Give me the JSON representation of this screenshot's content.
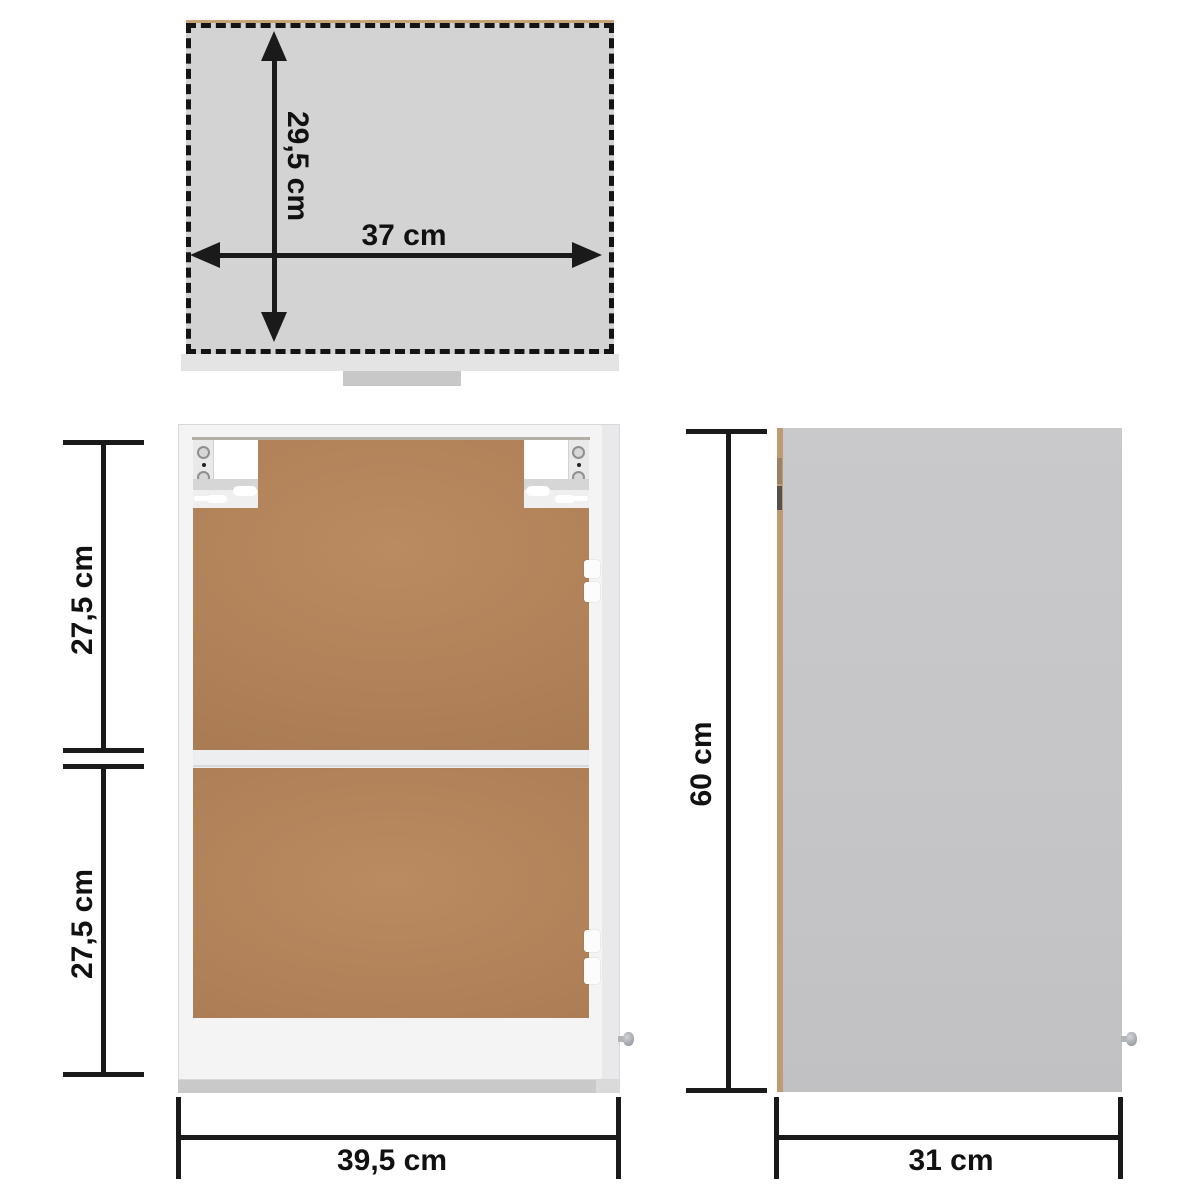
{
  "views": {
    "top": {
      "depth_label": "29,5 cm",
      "width_label": "37 cm"
    },
    "front": {
      "upper_section_label": "27,5 cm",
      "lower_section_label": "27,5 cm",
      "width_label": "39,5 cm"
    },
    "side": {
      "height_label": "60 cm",
      "depth_label": "31 cm"
    }
  },
  "colors": {
    "dimension_line": "#1a1a1a",
    "top_view_fill": "#d3d3d3",
    "side_view_fill": "#c5c5c7",
    "back_panel_brown": "#b08058",
    "cabinet_frame_white": "#f4f4f5",
    "wood_edge_tan": "#c09a72",
    "bottom_edge_gray": "#c9c9c9"
  }
}
